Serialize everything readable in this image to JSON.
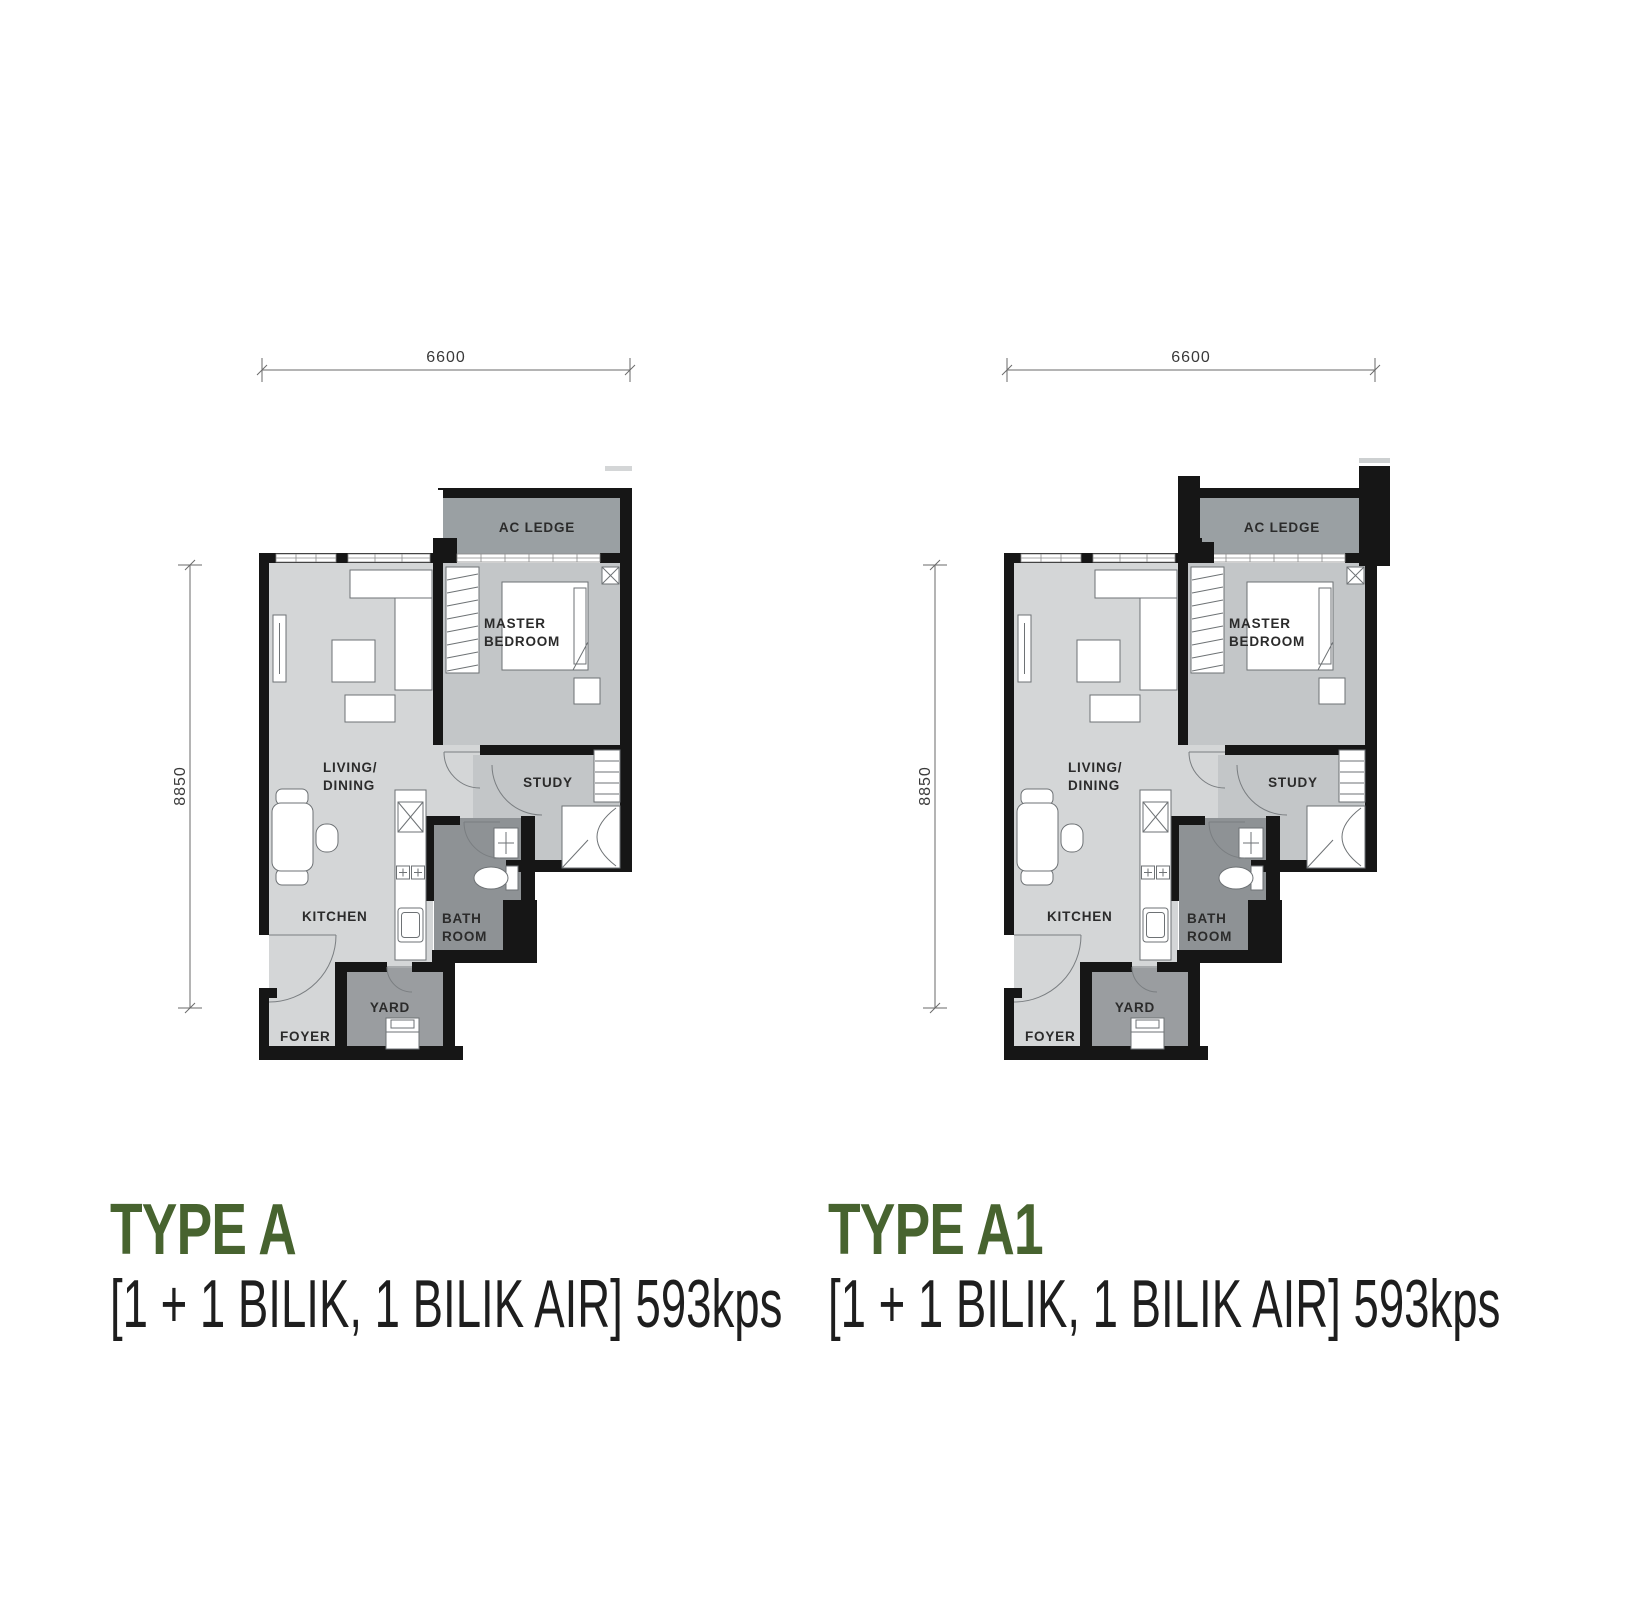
{
  "plans": [
    {
      "title": "TYPE A",
      "subtitle": "[1 + 1 BILIK, 1 BILIK AIR] 593kps",
      "dimensions": {
        "width": "6600",
        "height": "8850"
      },
      "rooms": {
        "ac_ledge": "AC LEDGE",
        "master_line1": "MASTER",
        "master_line2": "BEDROOM",
        "living_line1": "LIVING/",
        "living_line2": "DINING",
        "study": "STUDY",
        "kitchen": "KITCHEN",
        "bath_line1": "BATH",
        "bath_line2": "ROOM",
        "yard": "YARD",
        "foyer": "FOYER"
      }
    },
    {
      "title": "TYPE A1",
      "subtitle": "[1 + 1 BILIK, 1 BILIK AIR] 593kps",
      "dimensions": {
        "width": "6600",
        "height": "8850"
      },
      "rooms": {
        "ac_ledge": "AC LEDGE",
        "master_line1": "MASTER",
        "master_line2": "BEDROOM",
        "living_line1": "LIVING/",
        "living_line2": "DINING",
        "study": "STUDY",
        "kitchen": "KITCHEN",
        "bath_line1": "BATH",
        "bath_line2": "ROOM",
        "yard": "YARD",
        "foyer": "FOYER"
      }
    }
  ],
  "colors": {
    "accent_green": "#47632f",
    "wall_black": "#161616",
    "room_light_gray": "#d4d6d7",
    "room_mid_gray": "#c3c6c8",
    "ledge_gray": "#9aa0a3",
    "bath_gray": "#8e9295",
    "yard_gray": "#9a9da0",
    "spec_text": "#1e1e1e"
  }
}
